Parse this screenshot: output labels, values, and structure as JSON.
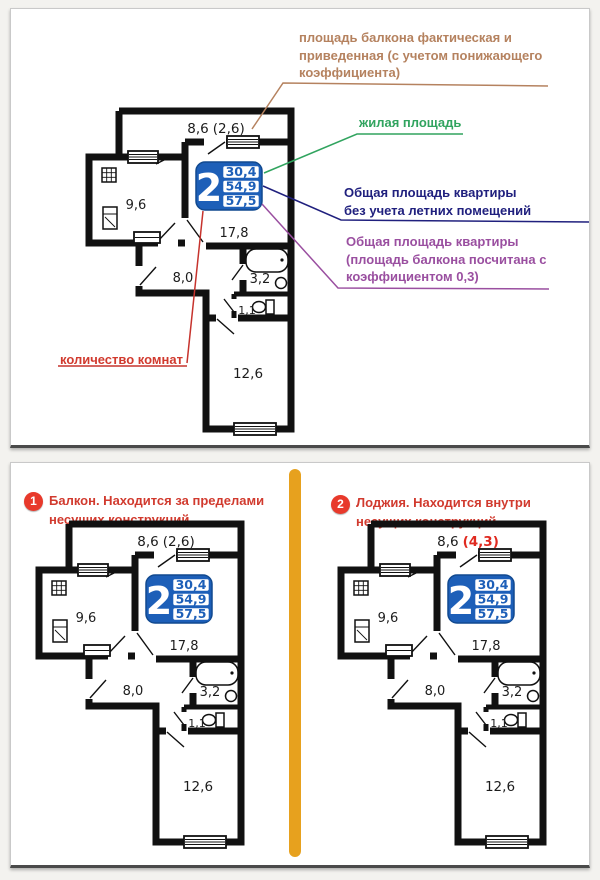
{
  "colors": {
    "balcony_note": "#b5825f",
    "living_area_green": "#31a45f",
    "total_no_summer_navy": "#20207e",
    "total_with_coef_purple": "#9a4fa0",
    "room_count_red": "#d13a2e",
    "badge_red": "#e8392b",
    "info_box_blue": "#1d5fb8",
    "divider_orange": "#e7a11e",
    "alt_balcony_value_red": "#e02a20",
    "walls_black": "#111111"
  },
  "top_panel": {
    "annotations": {
      "balcony_note": {
        "lines": [
          "площадь балкона фактическая и",
          "приведенная (с учетом понижающего",
          "коэффициента)"
        ]
      },
      "living_area": {
        "label": "жилая площадь"
      },
      "total_no_summer": {
        "lines": [
          "Общая площадь квартиры",
          "без учета летних помещений"
        ]
      },
      "total_with_coef": {
        "lines": [
          "Общая площадь квартиры",
          "(площадь балкона посчитана с",
          "коэффициентом 0,3)"
        ]
      },
      "room_count": {
        "label": "количество комнат"
      }
    },
    "plan": {
      "balcony_base": "8,6",
      "balcony_extra": "(2,6)",
      "balcony_extra_color": "#1c1c1c",
      "kitchen": "9,6",
      "living": "17,8",
      "hallway": "8,0",
      "bath": "3,2",
      "wc": "1,1",
      "bedroom": "12,6",
      "rooms": "2",
      "area_living": "30,4",
      "area_total": "54,9",
      "area_total_coef": "57,5"
    }
  },
  "bottom_panel": {
    "left": {
      "badge": "1",
      "title_lines": [
        "Балкон. Находится за пределами",
        "несущих конструкций"
      ],
      "plan": {
        "balcony_base": "8,6",
        "balcony_extra": "(2,6)",
        "balcony_extra_color": "#1c1c1c",
        "kitchen": "9,6",
        "living": "17,8",
        "hallway": "8,0",
        "bath": "3,2",
        "wc": "1,1",
        "bedroom": "12,6",
        "rooms": "2",
        "area_living": "30,4",
        "area_total": "54,9",
        "area_total_coef": "57,5"
      }
    },
    "right": {
      "badge": "2",
      "title_lines": [
        "Лоджия. Находится внутри",
        "несущих конструкций"
      ],
      "plan": {
        "balcony_base": "8,6",
        "balcony_extra": "(4,3)",
        "balcony_extra_color": "#e02a20",
        "kitchen": "9,6",
        "living": "17,8",
        "hallway": "8,0",
        "bath": "3,2",
        "wc": "1,1",
        "bedroom": "12,6",
        "rooms": "2",
        "area_living": "30,4",
        "area_total": "54,9",
        "area_total_coef": "57,5"
      }
    }
  }
}
